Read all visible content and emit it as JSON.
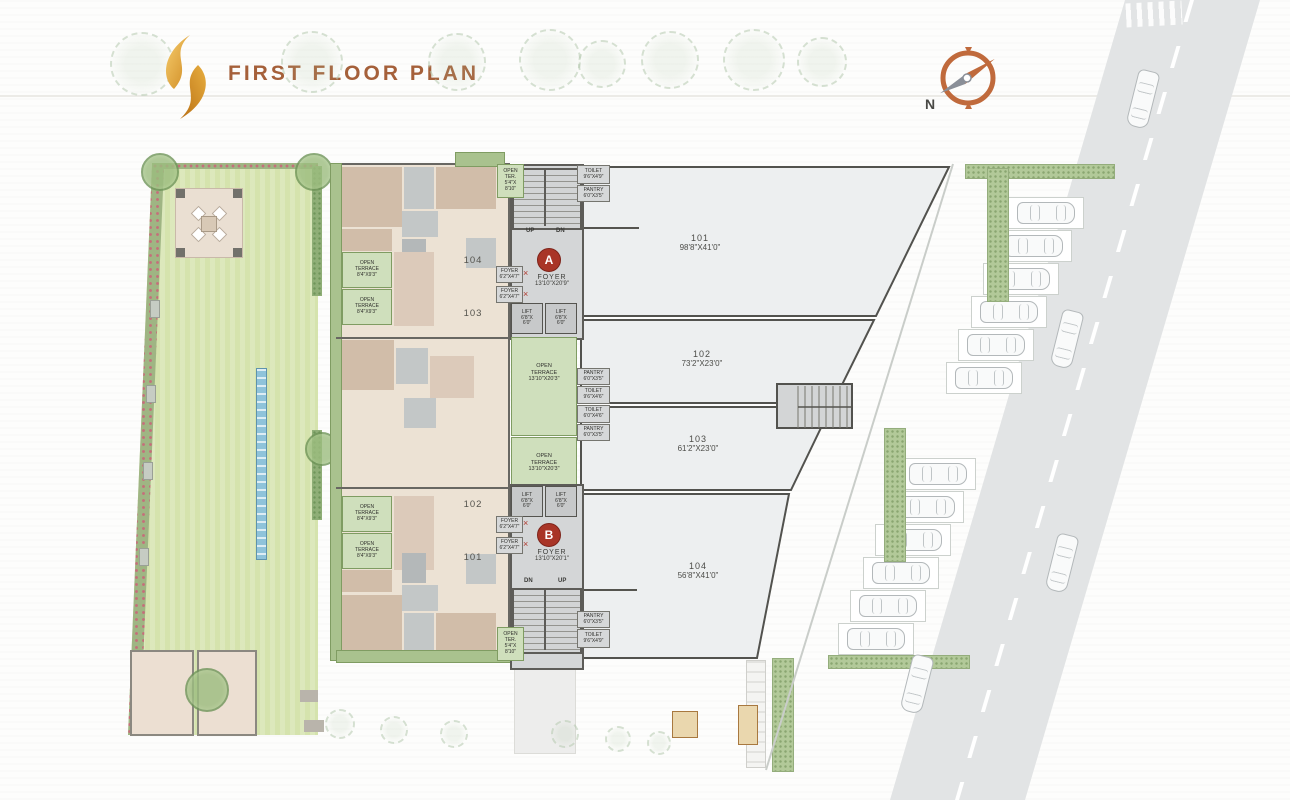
{
  "header": {
    "title": "FIRST FLOOR PLAN"
  },
  "compass": {
    "north": "N"
  },
  "units_right": [
    {
      "number": "101",
      "size": "98'8\"X41'0\""
    },
    {
      "number": "102",
      "size": "73'2\"X23'0\""
    },
    {
      "number": "103",
      "size": "61'2\"X23'0\""
    },
    {
      "number": "104",
      "size": "56'8\"X41'0\""
    }
  ],
  "units_left": {
    "top_a": "104",
    "top_b": "103",
    "bottom_a": "102",
    "bottom_b": "101"
  },
  "labels": {
    "open_terrace_small": {
      "l1": "OPEN",
      "l2": "TERRACE",
      "l3": "8'4\"X9'3\""
    },
    "open_terrace_large": {
      "l1": "OPEN",
      "l2": "TERRACE",
      "l3": "13'10\"X20'3\""
    },
    "open_ter_corner": {
      "l1": "OPEN",
      "l2": "TER.",
      "l3": "5'4\"X",
      "l4": "8'10\""
    },
    "lift": {
      "l1": "LIFT",
      "l2": "6'8\"X",
      "l3": "6'0\""
    },
    "foyer_small": {
      "l1": "FOYER",
      "l2": "6'2\"X4'7\""
    },
    "toilet_lg": {
      "l1": "TOILET",
      "l2": "9'6\"X4'9\""
    },
    "toilet_md": {
      "l1": "TOILET",
      "l2": "9'6\"X4'6\""
    },
    "toilet_sm": {
      "l1": "TOILET",
      "l2": "6'0\"X4'6\""
    },
    "pantry": {
      "l1": "PANTRY",
      "l2": "6'0\"X3'5\""
    }
  },
  "core_a": {
    "badge": "A",
    "name": "FOYER",
    "size": "13'10\"X20'9\"",
    "left_dir": "UP",
    "right_dir": "DN"
  },
  "core_b": {
    "badge": "B",
    "name": "FOYER",
    "size": "13'10\"X20'1\"",
    "left_dir": "DN",
    "right_dir": "UP"
  },
  "colors": {
    "accent_title": "#a5603a",
    "badge_red": "#a93527",
    "terrace_green": "#cfdfbc",
    "lawn_green": "#d5e3ad",
    "logo_gold": "#e0a33e",
    "wall_gray": "#55544f",
    "unit_fill": "#edeff0"
  }
}
